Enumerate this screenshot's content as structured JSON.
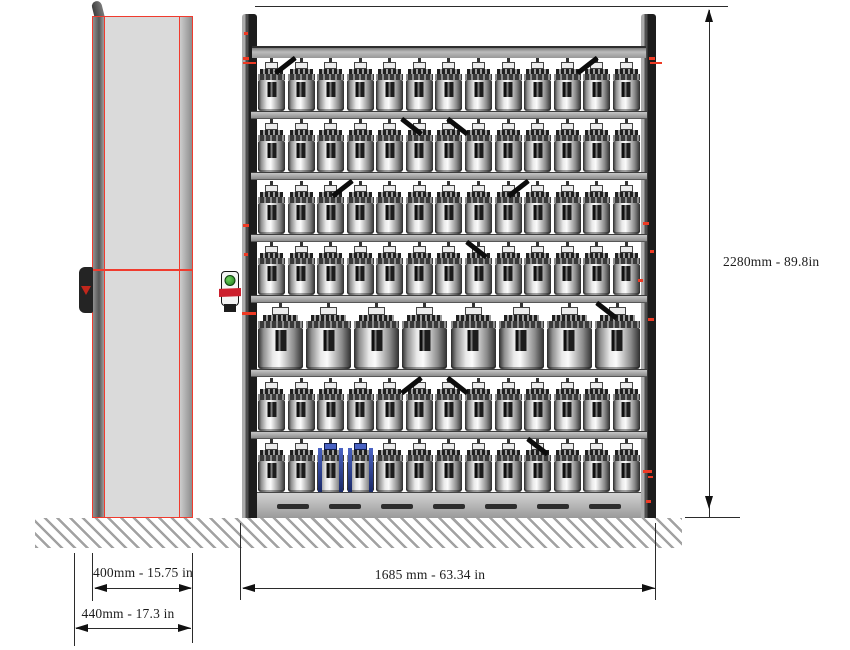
{
  "drawing": {
    "type": "technical-dimension-drawing",
    "views": {
      "side_view": "cabinet side profile",
      "front_view": "storage rack with 7 loaded shelf levels"
    }
  },
  "dimensions": {
    "total_height": "2280mm - 89.8in",
    "rack_width": "1685 mm - 63.34 in",
    "cabinet_depth": "400mm - 15.75 in",
    "cabinet_depth_total": "440mm - 17.3 in"
  },
  "rack": {
    "rows": [
      {
        "level": 1,
        "count": 13,
        "size": "small"
      },
      {
        "level": 2,
        "count": 13,
        "size": "small"
      },
      {
        "level": 3,
        "count": 13,
        "size": "small"
      },
      {
        "level": 4,
        "count": 13,
        "size": "small"
      },
      {
        "level": 5,
        "count": 8,
        "size": "large"
      },
      {
        "level": 6,
        "count": 13,
        "size": "small"
      },
      {
        "level": 7,
        "count": 13,
        "size": "small",
        "blue_cylinders_at": [
          3,
          4
        ]
      }
    ],
    "base_vent_slots": 7,
    "pointer_marks": [
      {
        "row": 1,
        "x": 0.07,
        "tilt": -38
      },
      {
        "row": 1,
        "x": 0.86,
        "tilt": -38
      },
      {
        "row": 2,
        "x": 0.4,
        "tilt": 38
      },
      {
        "row": 2,
        "x": 0.52,
        "tilt": 38
      },
      {
        "row": 3,
        "x": 0.22,
        "tilt": -38
      },
      {
        "row": 3,
        "x": 0.68,
        "tilt": -38
      },
      {
        "row": 4,
        "x": 0.57,
        "tilt": 38
      },
      {
        "row": 5,
        "x": 0.91,
        "tilt": 38
      },
      {
        "row": 6,
        "x": 0.4,
        "tilt": -38
      },
      {
        "row": 6,
        "x": 0.52,
        "tilt": 38
      },
      {
        "row": 7,
        "x": 0.73,
        "tilt": 38
      }
    ],
    "red_marks_left_post": [
      [
        244,
        32,
        4,
        3
      ],
      [
        243,
        57,
        6,
        3
      ],
      [
        243,
        62,
        13,
        2
      ],
      [
        243,
        224,
        6,
        3
      ],
      [
        244,
        253,
        4,
        3
      ],
      [
        242,
        312,
        14,
        3
      ]
    ],
    "red_marks_right_post": [
      [
        649,
        57,
        6,
        3
      ],
      [
        650,
        62,
        12,
        2
      ],
      [
        643,
        222,
        6,
        3
      ],
      [
        650,
        250,
        4,
        3
      ],
      [
        638,
        279,
        5,
        3
      ],
      [
        648,
        318,
        6,
        3
      ],
      [
        643,
        470,
        9,
        3
      ],
      [
        648,
        476,
        5,
        2
      ],
      [
        646,
        500,
        5,
        3
      ]
    ]
  },
  "colors": {
    "outline_red": "#f03b2e",
    "cabinet_fill": "#dadada",
    "blue_accent": "#2a3f8f",
    "green_indicator": "#2e9e3a",
    "dimension_text": "#1c1c1c"
  }
}
